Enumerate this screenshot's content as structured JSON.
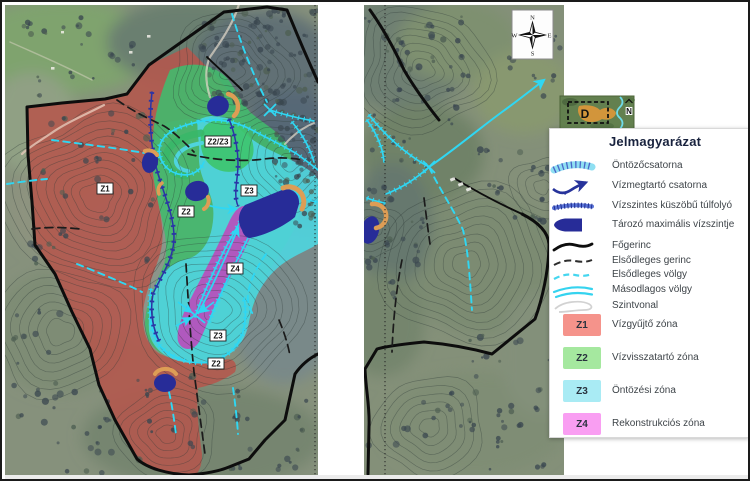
{
  "legend": {
    "title": "Jelmagyarázat",
    "items": [
      {
        "icon": "irrigation-channel-icon",
        "label": "Öntözőcsatorna"
      },
      {
        "icon": "water-retaining-channel-icon",
        "label": "Vízmegtartó csatorna"
      },
      {
        "icon": "spillway-icon",
        "label": "Vízszintes küszöbű túlfolyó"
      },
      {
        "icon": "reservoir-icon",
        "label": "Tározó maximális vízszintje"
      },
      {
        "icon": "main-ridge-icon",
        "label": "Főgerinc"
      },
      {
        "icon": "primary-ridge-icon",
        "label": "Elsődleges gerinc"
      },
      {
        "icon": "primary-valley-icon",
        "label": "Elsődleges völgy"
      },
      {
        "icon": "secondary-valley-icon",
        "label": "Másodlagos völgy"
      },
      {
        "icon": "contour-icon",
        "label": "Szintvonal"
      }
    ],
    "zones": [
      {
        "code": "Z1",
        "label": "Vízgyűjtő zóna",
        "color": "#f5938b"
      },
      {
        "code": "Z2",
        "label": "Vízvisszatartó zóna",
        "color": "#a5e89f"
      },
      {
        "code": "Z3",
        "label": "Öntözési zóna",
        "color": "#a9ebf4"
      },
      {
        "code": "Z4",
        "label": "Rekonstrukciós zóna",
        "color": "#f99ef2"
      }
    ]
  },
  "map": {
    "labels": [
      "Z1",
      "Z2/Z3",
      "Z2",
      "Z3",
      "Z4",
      "Z3",
      "Z2"
    ],
    "colors": {
      "zone_z1": "#b4564c",
      "zone_z2": "#43b96d",
      "zone_z2z3": "#3ec46f",
      "zone_z3": "#4fd4dd",
      "zone_z4": "#b552bd",
      "reservoir": "#272c98",
      "dam": "#dd9d55",
      "channel": "#2fd7f3",
      "retaining_channel": "#2b34a6",
      "ridge": "#0d0d0d"
    }
  },
  "compass": {
    "n": "N",
    "e": "E",
    "s": "S",
    "w": "W"
  },
  "inset": {
    "zone_label": "D",
    "north_label": "N"
  }
}
